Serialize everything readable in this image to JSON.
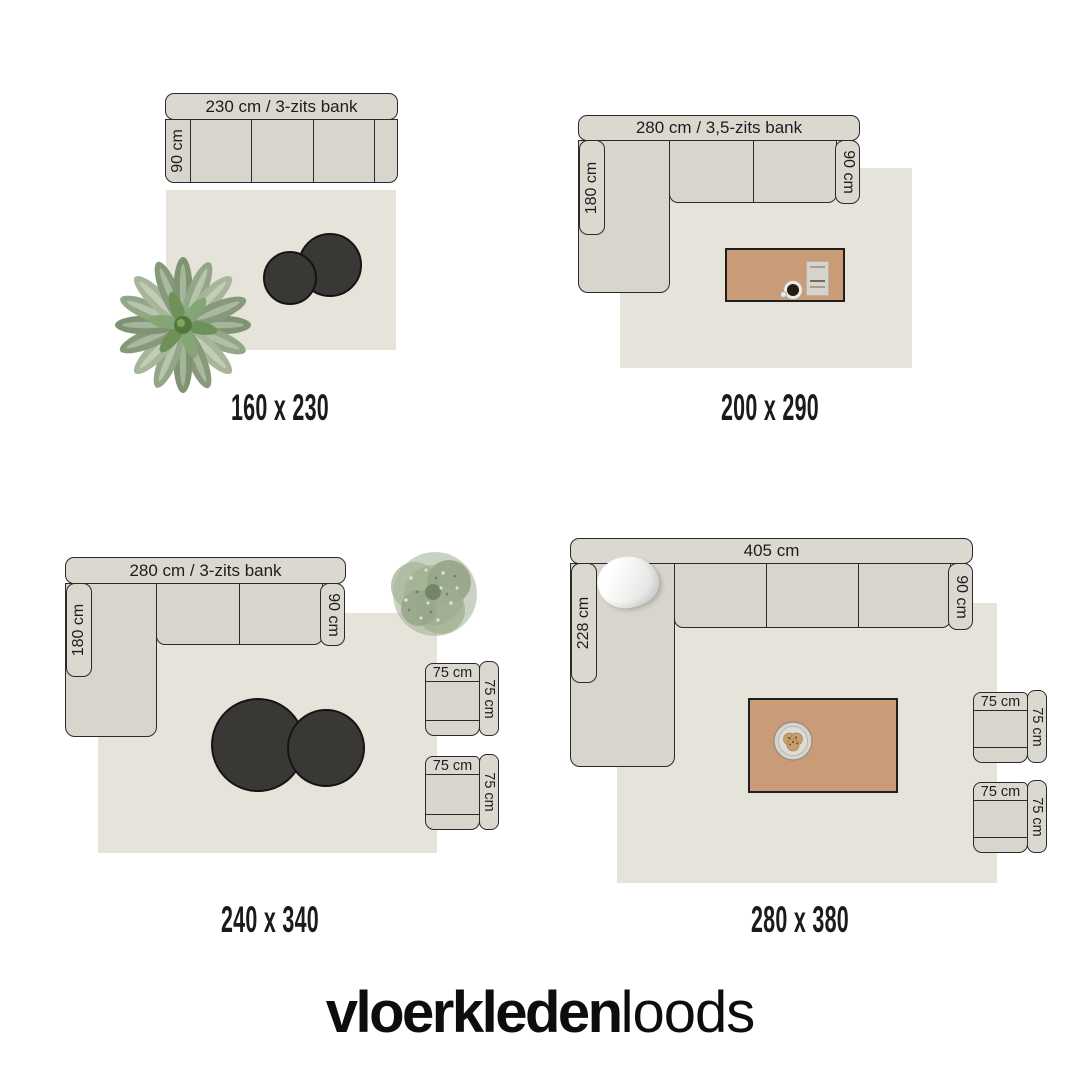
{
  "brand": {
    "bold": "vloerkleden",
    "light": "loods"
  },
  "colors": {
    "background": "#ffffff",
    "sofa_fill": "#d8d5cd",
    "sofa_outline": "#2a2a2a",
    "rug_fill": "#e6e3da",
    "side_table_fill": "#3a3835",
    "wood_table_fill": "#c99b76",
    "text": "#1d1d1d"
  },
  "scenes": [
    {
      "id": "rug-160x230",
      "size_label": "160 x 230",
      "sofa": {
        "width_label": "230 cm / 3-zits bank",
        "depth_label": "90 cm"
      }
    },
    {
      "id": "rug-200x290",
      "size_label": "200 x 290",
      "sofa": {
        "width_label": "280 cm / 3,5-zits bank",
        "chaise_label": "180 cm",
        "depth_label": "90 cm"
      }
    },
    {
      "id": "rug-240x340",
      "size_label": "240 x 340",
      "sofa": {
        "width_label": "280 cm / 3-zits bank",
        "chaise_label": "180 cm",
        "depth_label": "90 cm"
      },
      "armchairs": [
        {
          "width_label": "75 cm",
          "depth_label": "75 cm"
        },
        {
          "width_label": "75 cm",
          "depth_label": "75 cm"
        }
      ]
    },
    {
      "id": "rug-280x380",
      "size_label": "280 x 380",
      "sofa": {
        "width_label": "405 cm",
        "chaise_label": "228 cm",
        "depth_label": "90 cm"
      },
      "armchairs": [
        {
          "width_label": "75 cm",
          "depth_label": "75 cm"
        },
        {
          "width_label": "75 cm",
          "depth_label": "75 cm"
        }
      ]
    }
  ]
}
